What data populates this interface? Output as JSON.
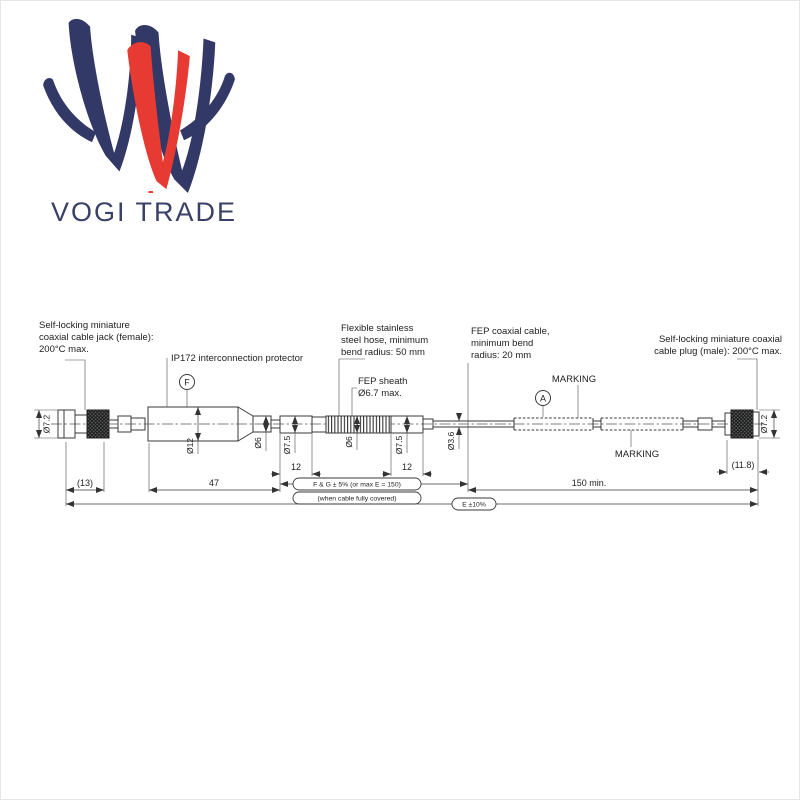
{
  "logo": {
    "brand": "VOGI TRADE",
    "navy": "#333966",
    "red": "#e63a32"
  },
  "diagram": {
    "labels": {
      "jack": [
        "Self-locking miniature",
        "coaxial cable jack (female):",
        "200°C max."
      ],
      "protector": "IP172 interconnection protector",
      "hose": [
        "Flexible stainless",
        "steel hose, minimum",
        "bend radius: 50 mm"
      ],
      "sheath": [
        "FEP sheath",
        "Ø6.7 max."
      ],
      "fep_cable": [
        "FEP coaxial cable,",
        "minimum bend",
        "radius: 20 mm"
      ],
      "marking_top": "MARKING",
      "marking_bottom": "MARKING",
      "plug": [
        "Self-locking miniature coaxial",
        "cable plug (male): 200°C max."
      ]
    },
    "balloons": {
      "f": "F",
      "a": "A"
    },
    "dimensions": {
      "jack_od": "Ø7.2",
      "jack_len": "(13)",
      "protector_len": "47",
      "protector_od": "Ø12",
      "neck_od": "Ø6",
      "ferrule_left_od": "Ø7.5",
      "ferrule_left_len": "12",
      "hose_od": "Ø6",
      "ferrule_right_od": "Ø7.5",
      "ferrule_right_len": "12",
      "cable_od": "Ø3.6",
      "cable_len": "150 min.",
      "plug_len": "(11.8)",
      "plug_od": "Ø7.2"
    },
    "notes": {
      "tolerance_fg": "F & G ± 5% (or max E = 150)",
      "coverage": "(when cable fully covered)",
      "tolerance_e": "E ±10%"
    }
  }
}
